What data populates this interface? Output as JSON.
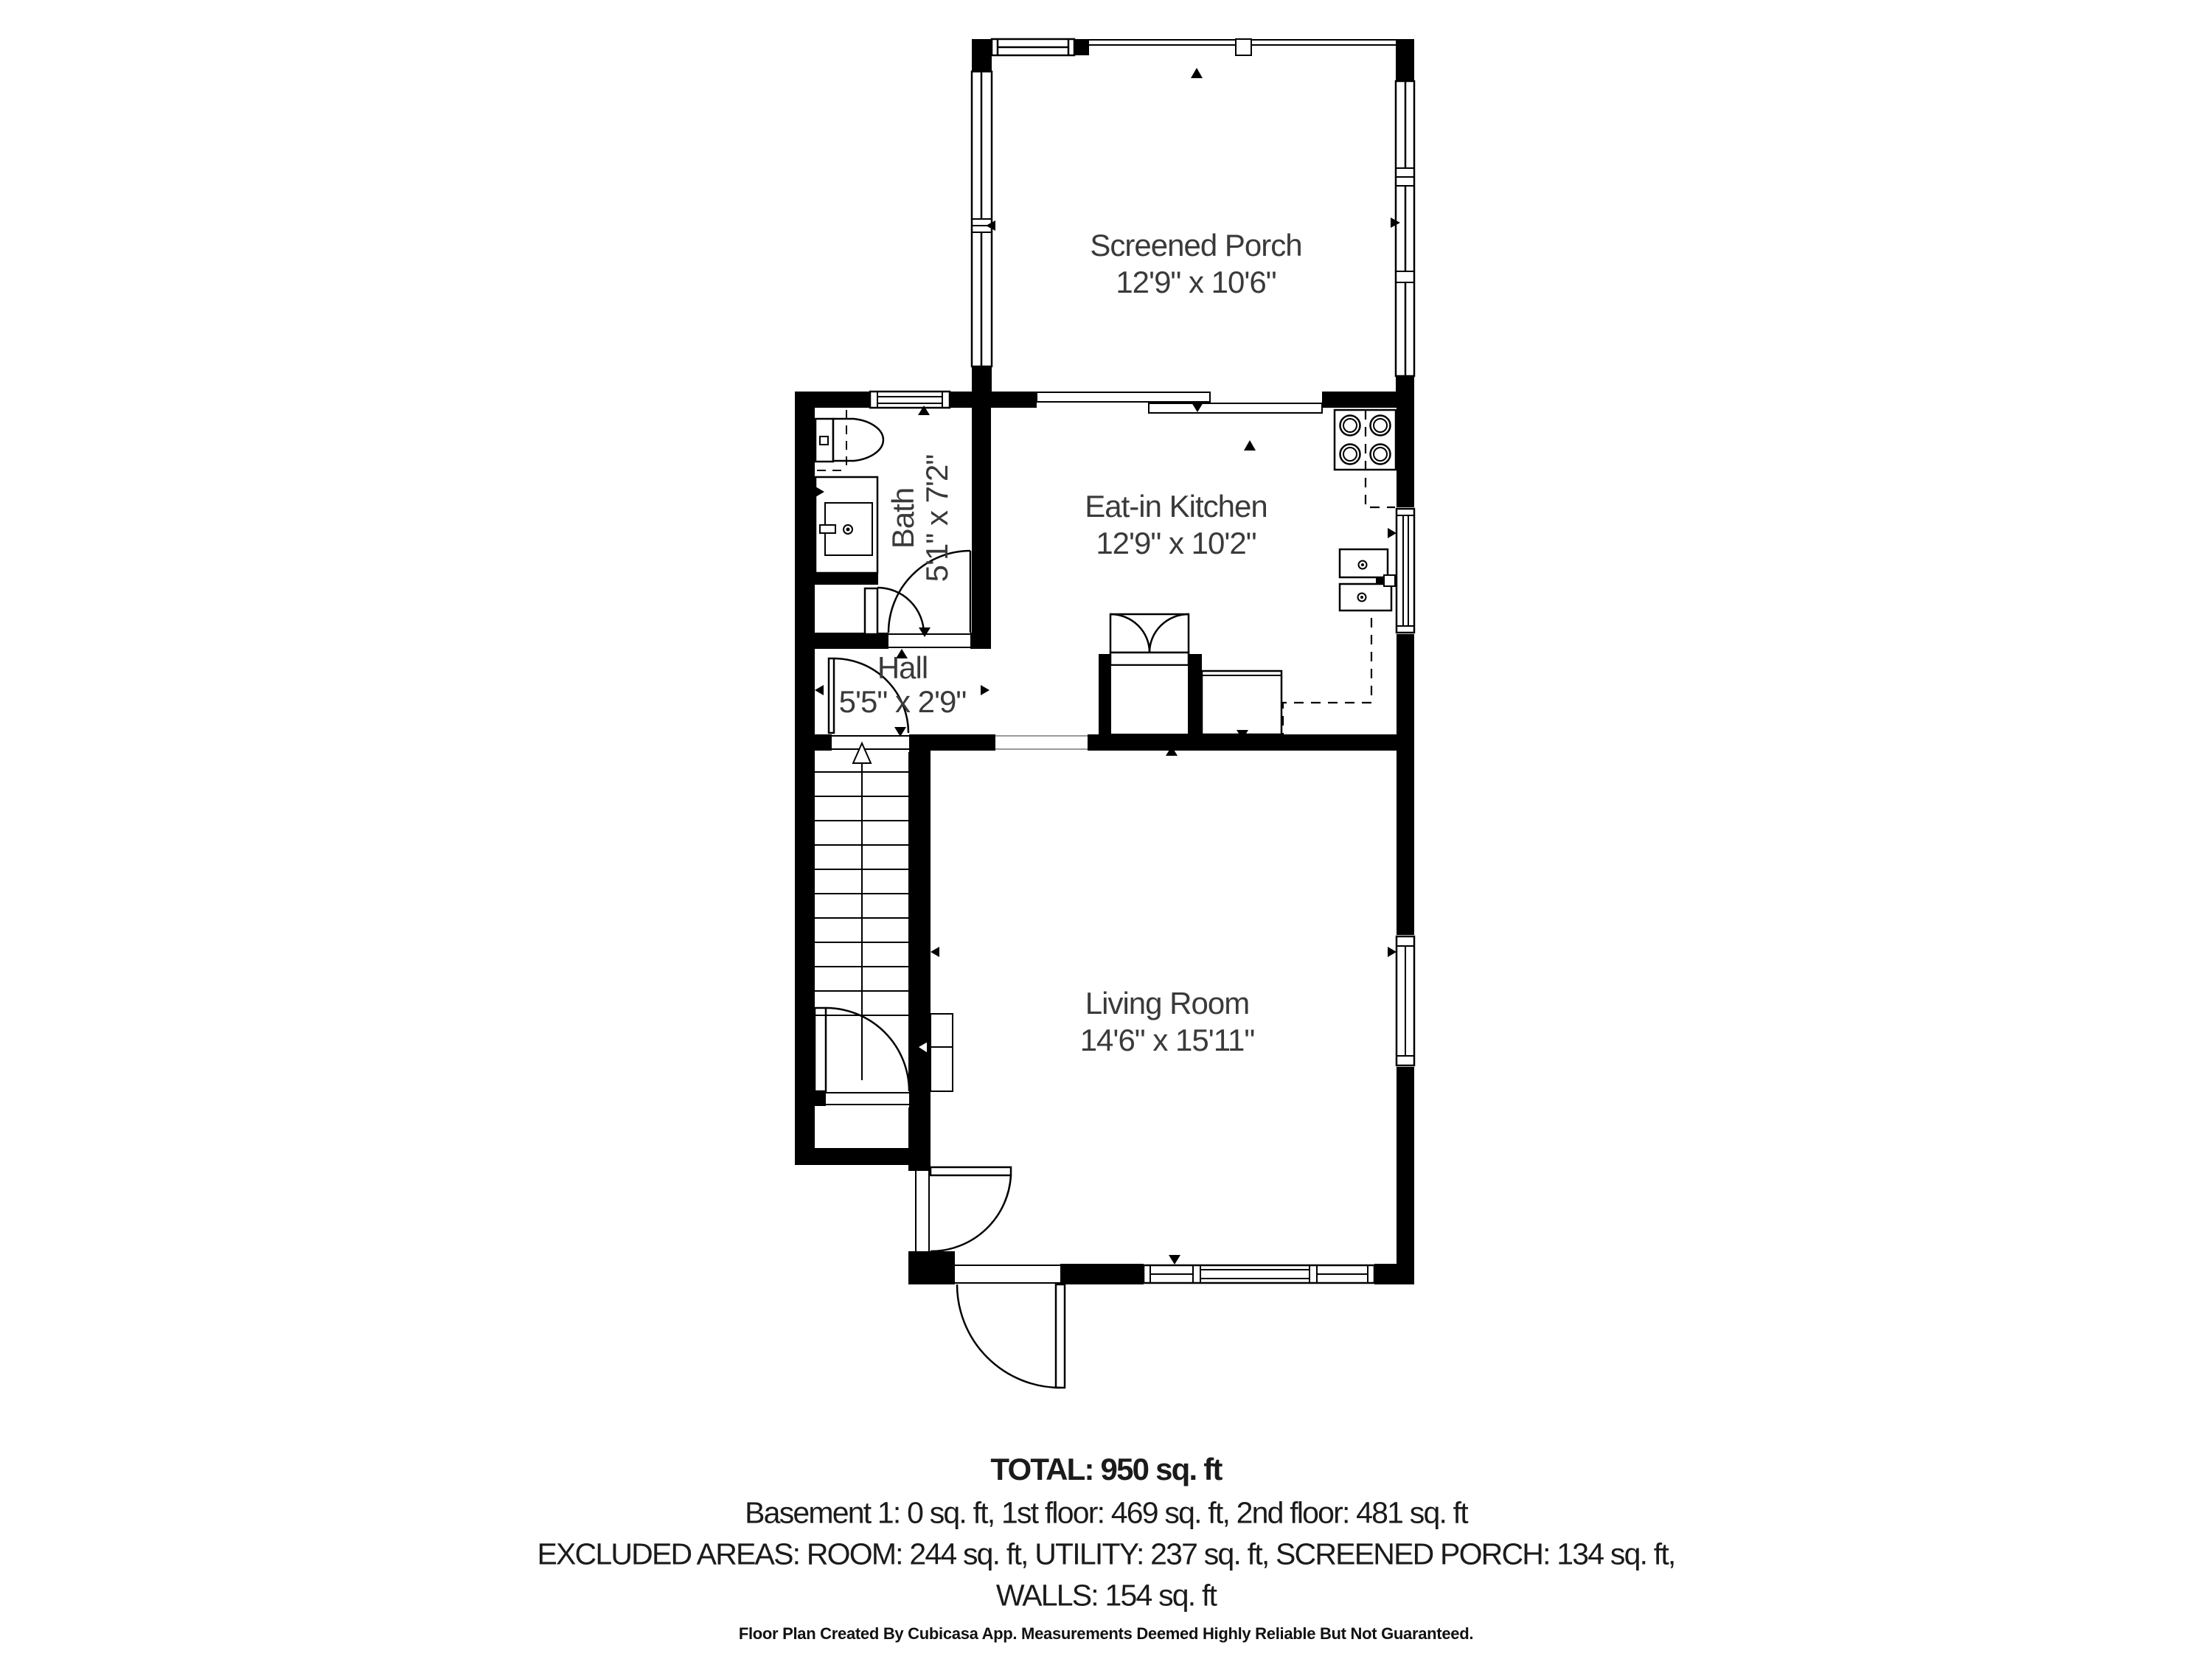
{
  "plan": {
    "creator": "Cubicasa",
    "colors": {
      "wall": "#000000",
      "background": "#ffffff",
      "label_text": "#3a3a3a",
      "summary_text": "#1b1b1b"
    },
    "rooms": [
      {
        "id": "screened-porch",
        "name": "Screened Porch",
        "dims": "12'9\" x 10'6\""
      },
      {
        "id": "eat-in-kitchen",
        "name": "Eat-in Kitchen",
        "dims": "12'9\" x 10'2\""
      },
      {
        "id": "bath",
        "name": "Bath",
        "dims": "5'1\" x 7'2\""
      },
      {
        "id": "hall",
        "name": "Hall",
        "dims": "5'5\" x 2'9\""
      },
      {
        "id": "living-room",
        "name": "Living Room",
        "dims": "14'6\" x 15'11\""
      }
    ]
  },
  "summary": {
    "total": "TOTAL: 950 sq. ft",
    "floors": "Basement 1: 0 sq. ft, 1st floor: 469 sq. ft, 2nd floor: 481 sq. ft",
    "excluded": "EXCLUDED AREAS: ROOM: 244 sq. ft, UTILITY: 237 sq. ft, SCREENED PORCH: 134 sq. ft,",
    "excluded_cont": "WALLS: 154 sq. ft",
    "disclaimer": "Floor Plan Created By Cubicasa App. Measurements Deemed Highly Reliable But Not Guaranteed."
  }
}
